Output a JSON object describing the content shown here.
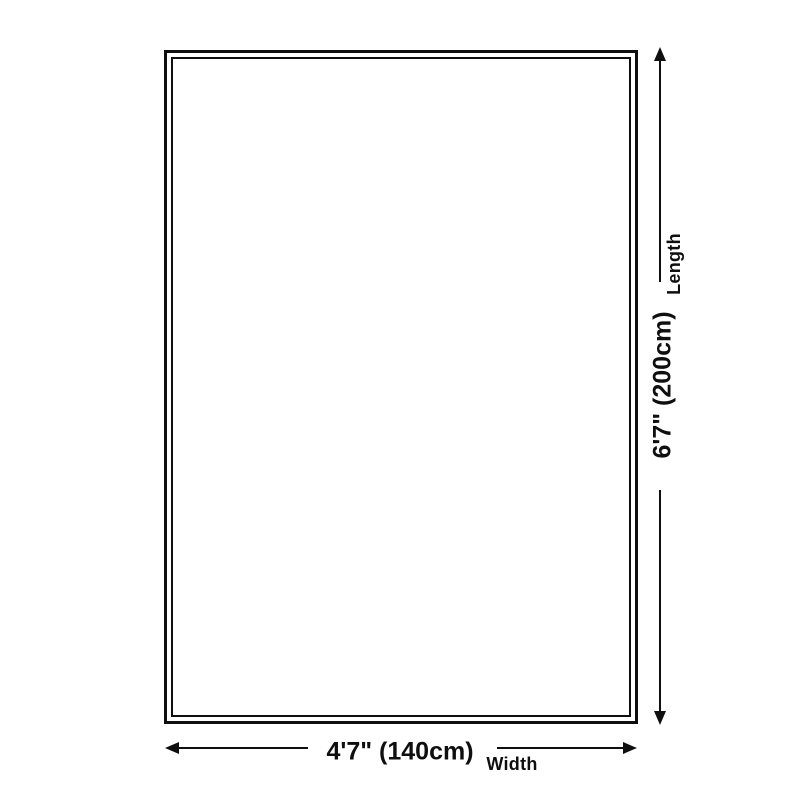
{
  "page": {
    "background_color": "#ffffff",
    "line_color": "#0f0f0f"
  },
  "diagram": {
    "type": "product-size-diagram",
    "width_dimension": {
      "value": "4'7\" (140cm)",
      "label": "Width"
    },
    "length_dimension": {
      "value": "6'7\" (200cm)",
      "label": "Length"
    }
  }
}
